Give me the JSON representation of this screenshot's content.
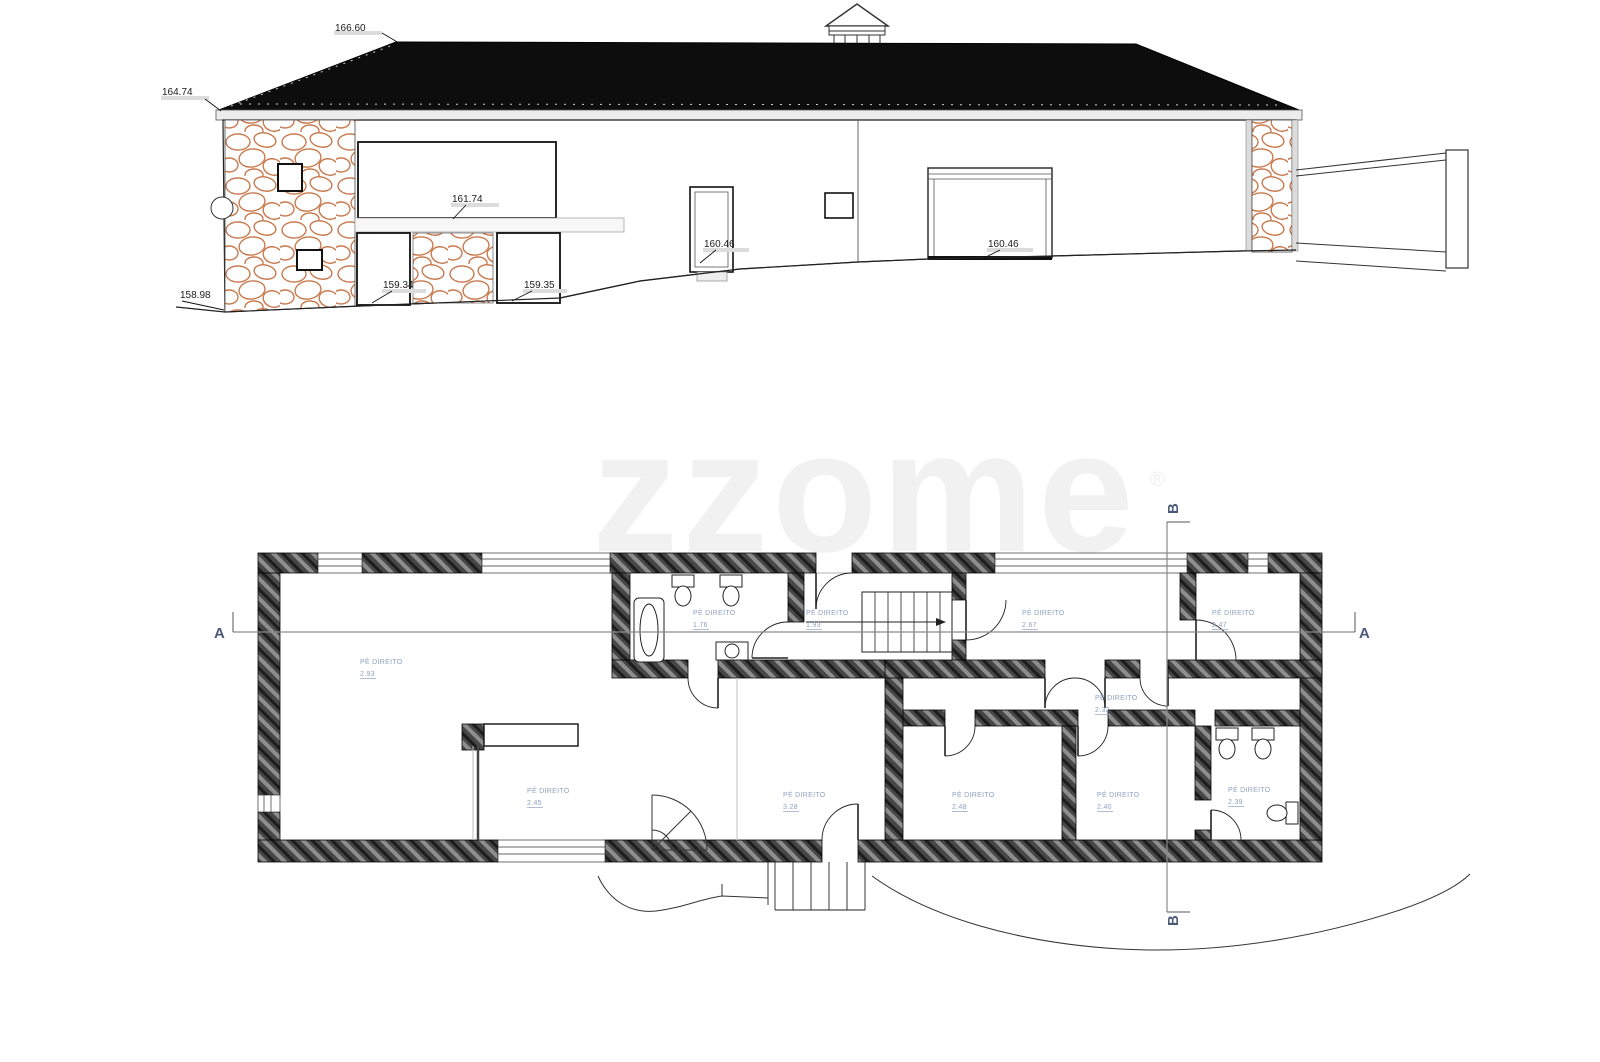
{
  "watermark": {
    "brand": "zzome",
    "registered": "®"
  },
  "elevation_labels": {
    "ridge": "166.60",
    "eave_left": "164.74",
    "window_band": "161.74",
    "entry_door": "160.46",
    "garage_door": "160.46",
    "opening_left": "159.34",
    "opening_right": "159.35",
    "ground_left": "158.98"
  },
  "floor_plan": {
    "ceiling_height_label": "PÉ DIREITO",
    "section_a": "A",
    "section_b": "B",
    "rooms": [
      {
        "name": "living-room",
        "height": "2.93"
      },
      {
        "name": "kitchen",
        "height": "2.45"
      },
      {
        "name": "bathroom-1",
        "height": "1.76"
      },
      {
        "name": "entrance-hall",
        "height": "1.93"
      },
      {
        "name": "corridor",
        "height": "2.67"
      },
      {
        "name": "room-top-right",
        "height": "2.47"
      },
      {
        "name": "hallway",
        "height": "2.32"
      },
      {
        "name": "middle-room",
        "height": "3.28"
      },
      {
        "name": "bedroom-1",
        "height": "2.48"
      },
      {
        "name": "bedroom-2",
        "height": "2.40"
      },
      {
        "name": "bathroom-2",
        "height": "2.39"
      }
    ]
  },
  "colors": {
    "roof": "#0d0d0d",
    "stone_outline": "#c97a4f",
    "wall_hatch": "#4a4a4a",
    "room_label": "#8fa3c0",
    "section_marker": "#4b5a78"
  }
}
